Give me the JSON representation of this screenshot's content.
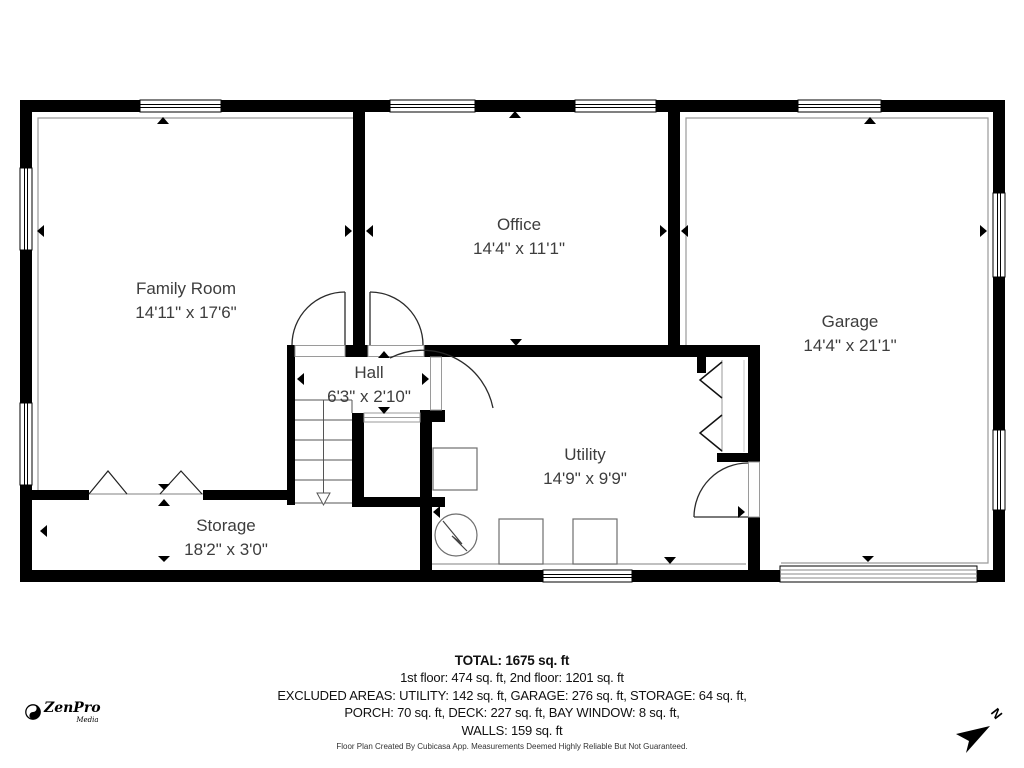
{
  "branding": {
    "logo_text": "ZenPro",
    "logo_sub": "Media"
  },
  "compass": {
    "label": "N"
  },
  "rooms": [
    {
      "name": "Family Room",
      "dims": "14'11\" x 17'6\""
    },
    {
      "name": "Office",
      "dims": "14'4\" x 11'1\""
    },
    {
      "name": "Garage",
      "dims": "14'4\" x 21'1\""
    },
    {
      "name": "Hall",
      "dims": "6'3\" x 2'10\""
    },
    {
      "name": "Utility",
      "dims": "14'9\" x 9'9\""
    },
    {
      "name": "Storage",
      "dims": "18'2\" x 3'0\""
    }
  ],
  "summary": {
    "total": "TOTAL: 1675 sq. ft",
    "floors": "1st floor: 474 sq. ft, 2nd floor: 1201 sq. ft",
    "excluded_line1": "EXCLUDED AREAS: UTILITY: 142 sq. ft, GARAGE: 276 sq. ft, STORAGE: 64 sq. ft,",
    "excluded_line2": "PORCH: 70 sq. ft, DECK: 227 sq. ft, BAY WINDOW: 8 sq. ft,",
    "excluded_line3": "WALLS: 159 sq. ft",
    "disclaimer": "Floor Plan Created By Cubicasa App. Measurements Deemed Highly Reliable But Not Guaranteed."
  },
  "colors": {
    "wall": "#000000",
    "inset_line": "#9a9a9a",
    "label_text": "#3d3d3d"
  }
}
